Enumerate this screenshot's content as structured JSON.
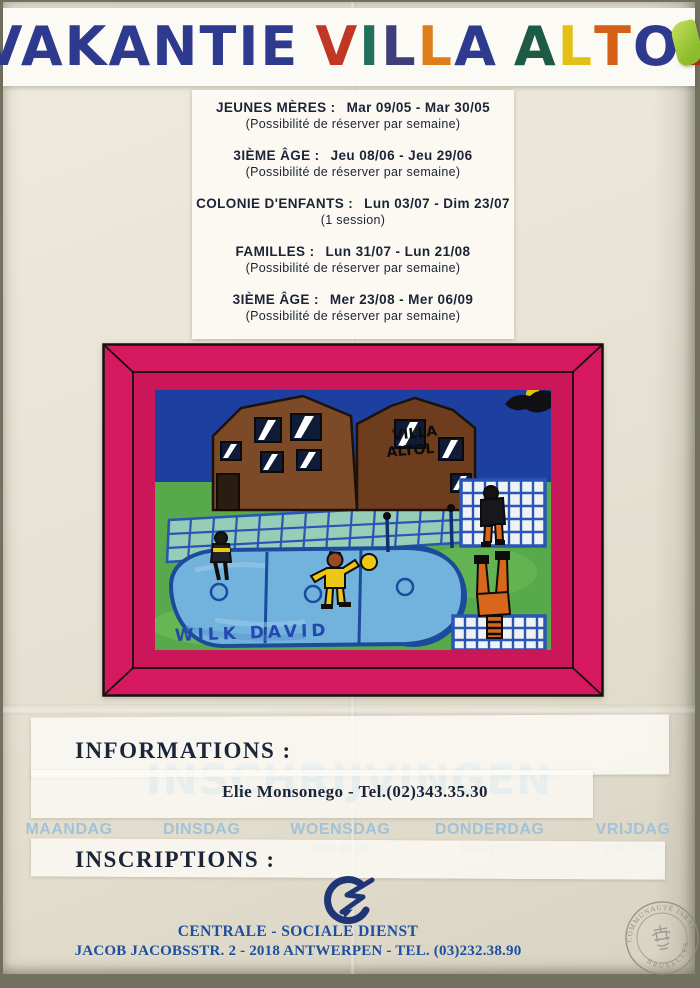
{
  "title": {
    "word1": "VAKANTIE",
    "word1_color": "#2e3a8e",
    "villa_letters": [
      {
        "ch": "V",
        "color": "#c03726"
      },
      {
        "ch": "I",
        "color": "#20705c"
      },
      {
        "ch": "L",
        "color": "#3d3f7a"
      },
      {
        "ch": "L",
        "color": "#df7d18"
      },
      {
        "ch": "A",
        "color": "#2e3a8e"
      }
    ],
    "altol_letters": [
      {
        "ch": "A",
        "color": "#1e5b46"
      },
      {
        "ch": "L",
        "color": "#e3c013"
      },
      {
        "ch": "T",
        "color": "#d55f16"
      },
      {
        "ch": "O",
        "color": "#2e3a8e"
      },
      {
        "ch": "L",
        "color": "#c22a18"
      }
    ]
  },
  "schedule": {
    "items": [
      {
        "label": "JEUNES MÈRES :",
        "dates": "Mar 09/05 - Mar 30/05",
        "note": "(Possibilité de réserver par semaine)"
      },
      {
        "label": "3IÈME ÂGE :",
        "dates": "Jeu 08/06 - Jeu 29/06",
        "note": "(Possibilité de réserver par semaine)"
      },
      {
        "label": "COLONIE D'ENFANTS :",
        "dates": "Lun 03/07 - Dim 23/07",
        "note": "(1 session)"
      },
      {
        "label": "FAMILLES :",
        "dates": "Lun 31/07 - Lun 21/08",
        "note": "(Possibilité de réserver par semaine)"
      },
      {
        "label": "3IÈME ÂGE :",
        "dates": "Mer 23/08 - Mer 06/09",
        "note": "(Possibilité de réserver par semaine)"
      }
    ]
  },
  "drawing": {
    "frame_color": "#d6185e",
    "building_label_1": "VILLA",
    "building_label_2": "ALTOL",
    "signature": "WILK DAVID"
  },
  "underprint": {
    "headline": "INSCHRIJVINGEN",
    "columns": [
      {
        "day": "MAANDAG",
        "time": ""
      },
      {
        "day": "DINSDAG",
        "time": ""
      },
      {
        "day": "WOENSDAG",
        "time": "8.00-18.00"
      },
      {
        "day": "DONDERDAG",
        "time": "8.00-20.00"
      },
      {
        "day": "VRIJDAG",
        "time": "8.00-13.00"
      }
    ]
  },
  "info": {
    "informations_label": "INFORMATIONS :",
    "contact": "Elie Monsonego - Tel.(02)343.35.30",
    "inscriptions_label": "INSCRIPTIONS :"
  },
  "footer": {
    "org_name": "CENTRALE - SOCIALE DIENST",
    "address_line": "JACOB JACOBSSTR. 2 - 2018 ANTWERPEN - TEL. (03)232.38.90",
    "stamp_text_top": "COMMUNAUTÉ ISRAÉLITE DE",
    "stamp_text_bottom": "BRUXELLES"
  }
}
